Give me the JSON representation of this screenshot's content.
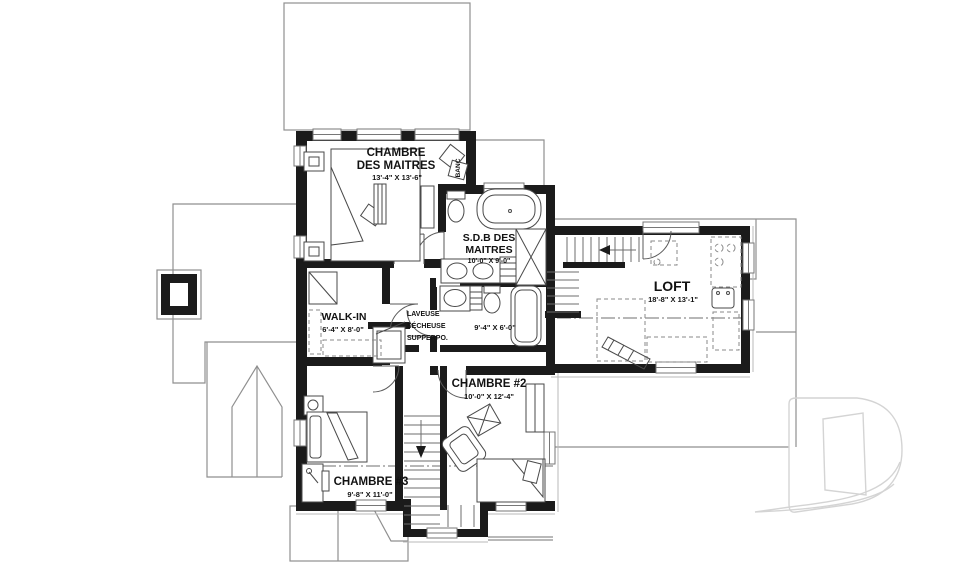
{
  "title": "Plan d'étage — floor plan",
  "colors": {
    "wall": "#1b1b1b",
    "roof_line": "#8f8f8f",
    "furniture_line": "#4a4a4a",
    "watermark": "#d4d4d4",
    "background": "#ffffff"
  },
  "rooms": {
    "master_bedroom": {
      "name_line1": "CHAMBRE",
      "name_line2": "DES MAITRES",
      "dimensions": "13'-4\" X 13'-6\""
    },
    "bench_nook": {
      "name": "BANC"
    },
    "master_bath": {
      "name_line1": "S.D.B DES",
      "name_line2": "MAITRES",
      "dimensions": "10'-0\" X 9'-0\""
    },
    "walk_in": {
      "name": "WALK-IN",
      "dimensions": "6'-4\" X 8'-0\""
    },
    "laundry": {
      "line1": "LAVEUSE",
      "line2": "SÉCHEUSE",
      "line3": "SUPPERPO."
    },
    "bathroom_2": {
      "dimensions": "9'-4\" X 6'-0\""
    },
    "loft": {
      "name": "LOFT",
      "dimensions": "18'-8\" X 13'-1\""
    },
    "bedroom_2": {
      "name": "CHAMBRE #2",
      "dimensions": "10'-0\" X 12'-4\""
    },
    "bedroom_3": {
      "name": "CHAMBRE #3",
      "dimensions": "9'-8\" X 11'-0\""
    }
  },
  "watermark": {
    "letter": "D"
  }
}
